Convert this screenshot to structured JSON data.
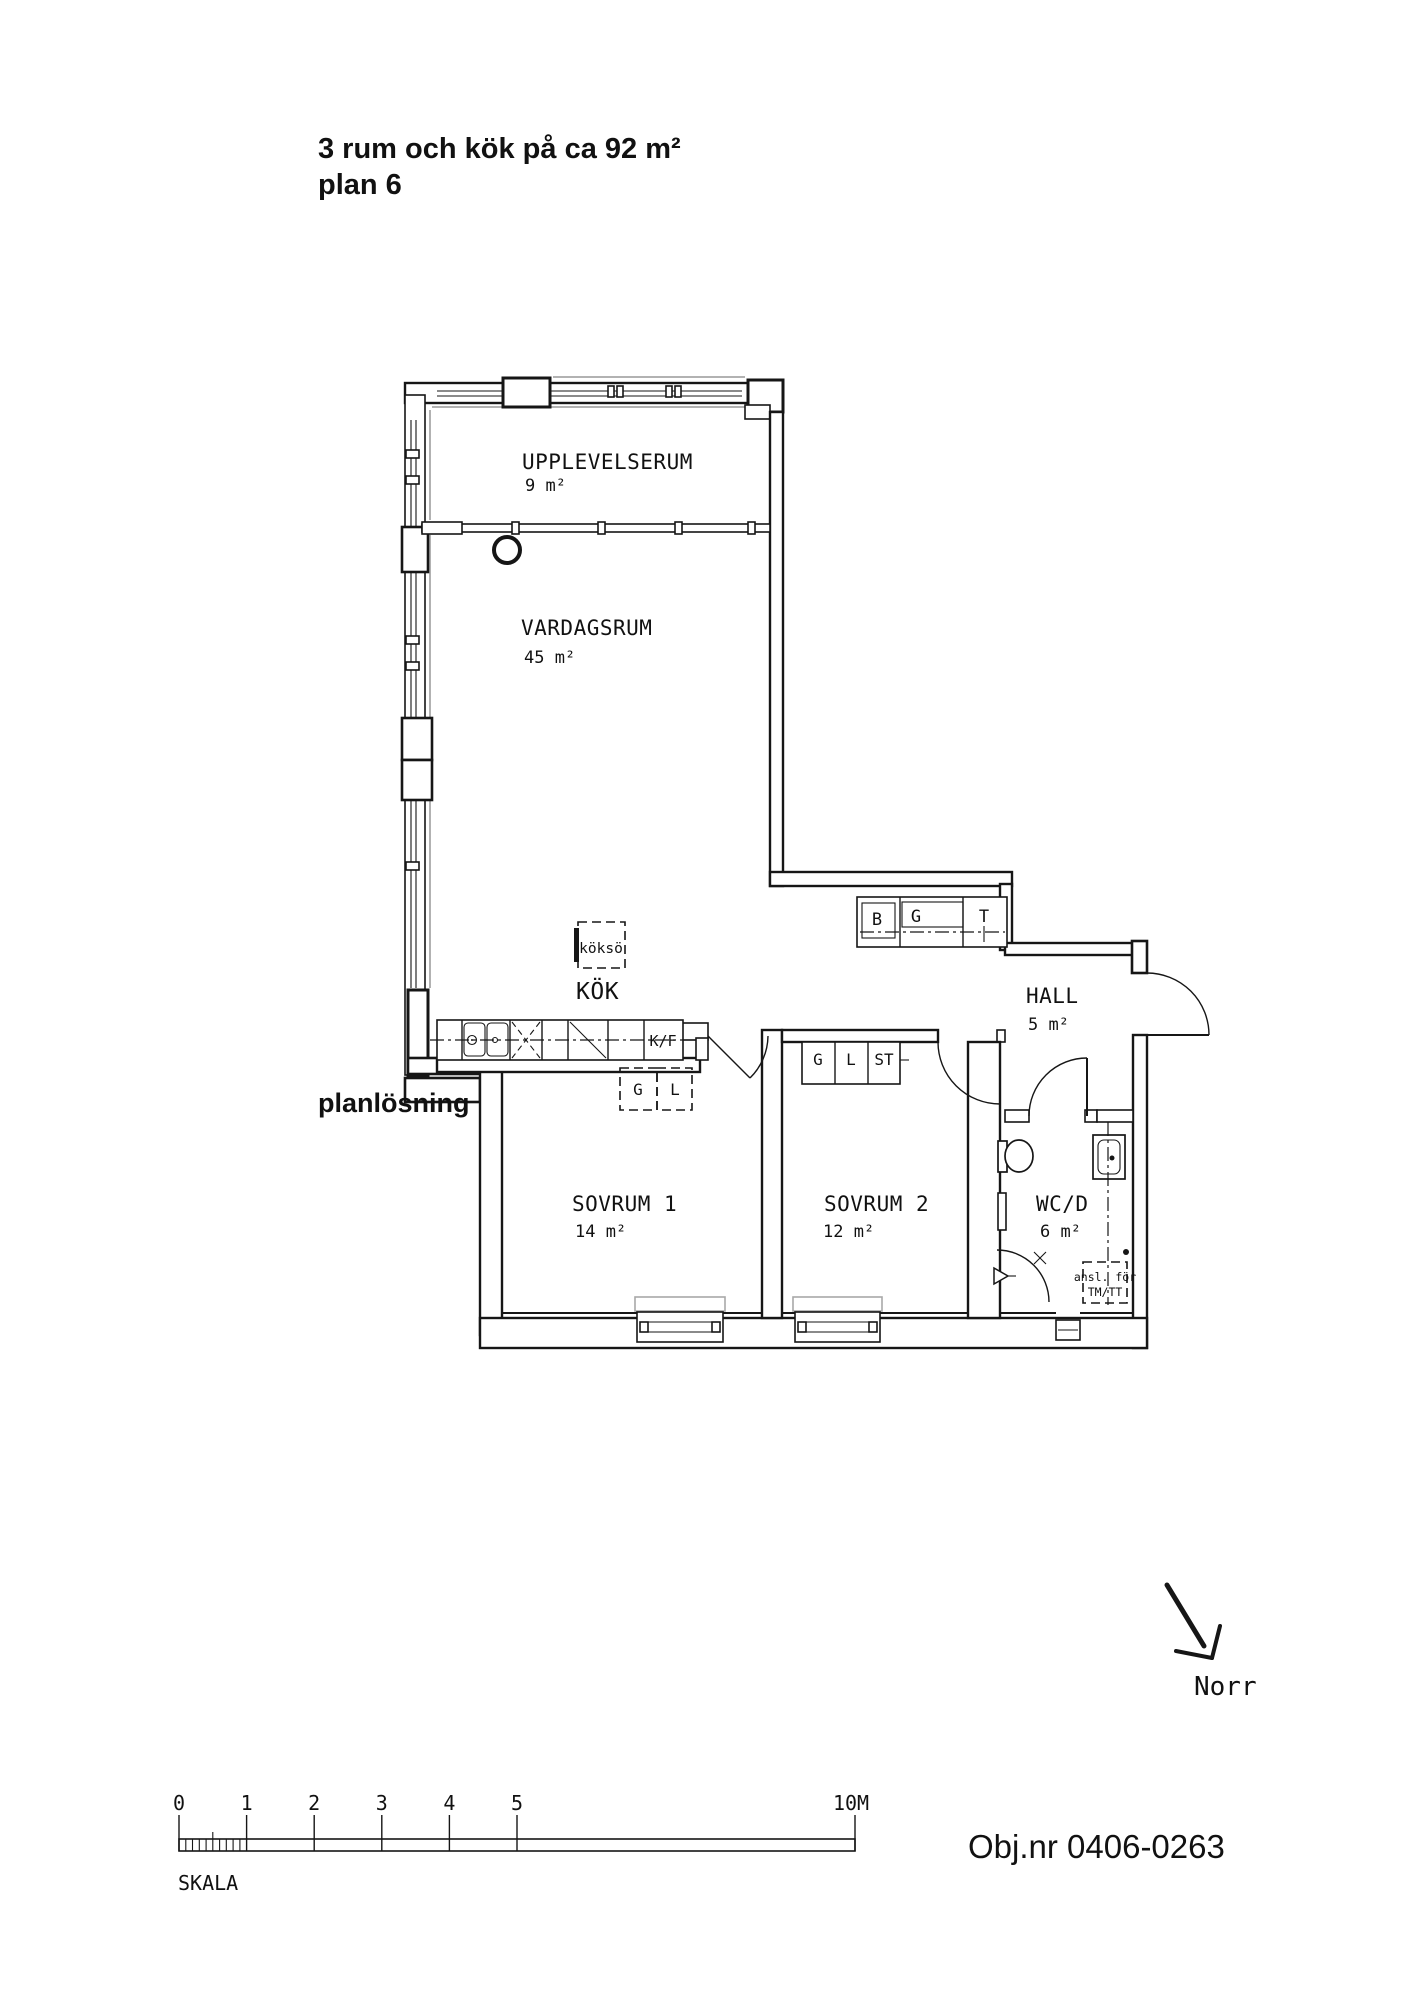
{
  "header": {
    "title_line1": "3 rum och kök på ca 92  m²",
    "title_line2": "plan 6"
  },
  "caption": "planlösning",
  "object_number": "Obj.nr 0406-0263",
  "north": {
    "label": "Norr"
  },
  "scale_bar": {
    "label": "SKALA",
    "ticks": [
      "0",
      "1",
      "2",
      "3",
      "4",
      "5"
    ],
    "end_label": "10M"
  },
  "rooms": {
    "upplevelserum": {
      "name": "UPPLEVELSERUM",
      "area": "9 m²"
    },
    "vardagsrum": {
      "name": "VARDAGSRUM",
      "area": "45 m²"
    },
    "kok": {
      "name": "KÖK"
    },
    "hall": {
      "name": "HALL",
      "area": "5 m²"
    },
    "sovrum1": {
      "name": "SOVRUM 1",
      "area": "14 m²"
    },
    "sovrum2": {
      "name": "SOVRUM 2",
      "area": "12 m²"
    },
    "wcd": {
      "name": "WC/D",
      "area": "6 m²"
    }
  },
  "fixtures": {
    "island_label": "köksö",
    "fridge_label": "K/F",
    "hall_closets": [
      "B",
      "G",
      "T"
    ],
    "bedroom_closets": [
      "G",
      "L",
      "ST"
    ],
    "kitchen_cabinets": [
      "G",
      "L"
    ],
    "washer_note": [
      "ansl. för",
      "TM/TT"
    ]
  }
}
